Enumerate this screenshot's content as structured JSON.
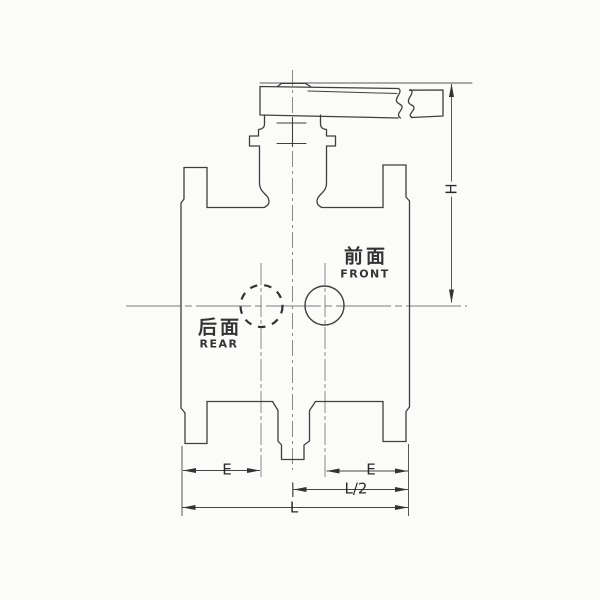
{
  "drawing": {
    "kind": "valve-outline-front-elevation",
    "colors": {
      "ink": "#3f3f3f",
      "thin_line": "#7d7d7d",
      "background": "#fbfbfa"
    }
  },
  "annotations": {
    "front": {
      "cn": "前面",
      "en": "FRONT"
    },
    "rear": {
      "cn": "后面",
      "en": "REAR"
    }
  },
  "dimensions": {
    "height_label": "H",
    "left_face_to_port_label": "E",
    "right_face_to_port_label": "E",
    "half_length_label": "L/2",
    "length_label": "L"
  }
}
